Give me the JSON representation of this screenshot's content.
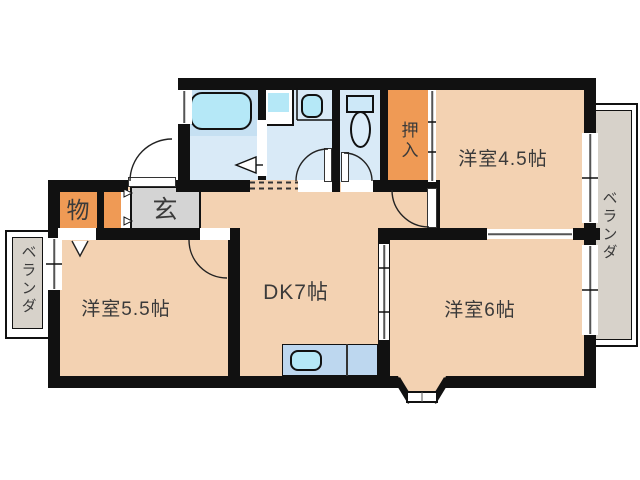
{
  "plan": {
    "rooms": {
      "western_room_45": "洋室4.5帖",
      "western_room_55": "洋室5.5帖",
      "western_room_6": "洋室6帖",
      "dining_kitchen": "DK7帖",
      "entrance": "玄",
      "storage": "物",
      "oshiire": "押入",
      "veranda_right": "ベランダ",
      "veranda_left": "ベランダ"
    },
    "colors": {
      "wall": "#111111",
      "room_peach": "#f3d2b2",
      "closet_orange": "#ef9a55",
      "wet_room_blue": "#d9eaf7",
      "bath_band_blue": "#c6e0f2",
      "fixture_cyan": "#b5e8f7",
      "entrance_gray": "#d4d4d4",
      "veranda_gray": "#d7d2ca",
      "kitchen_counter_blue": "#bdd7ef"
    }
  }
}
